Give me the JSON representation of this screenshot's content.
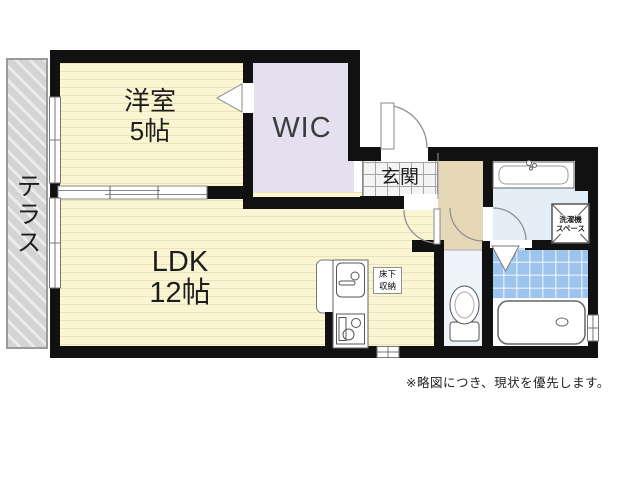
{
  "floorplan": {
    "rooms": {
      "terrace": {
        "label": "テラス"
      },
      "western_room": {
        "label": "洋室",
        "size": "5帖"
      },
      "wic": {
        "label": "WIC"
      },
      "ldk": {
        "label": "LDK",
        "size": "12帖"
      },
      "genkan": {
        "label": "玄関"
      }
    },
    "fixtures": {
      "underfloor_storage": {
        "line1": "床下",
        "line2": "収納"
      },
      "washing_machine_space": {
        "line1": "洗濯機",
        "line2": "スペース"
      }
    },
    "note": "※略図につき、現状を優先します。",
    "colors": {
      "wall": "#111111",
      "tatami_yellow": "#faf6d3",
      "tatami_stripe": "#ece4b8",
      "wic_lavender": "#e4e0ef",
      "hallway_beige": "#e6d7b6",
      "washroom_blue": "#e4eef7",
      "toilet_blue": "#edf3f9",
      "bath_tile_blue": "#9cc4ec",
      "terrace_gray": "#d4d4d4"
    }
  }
}
